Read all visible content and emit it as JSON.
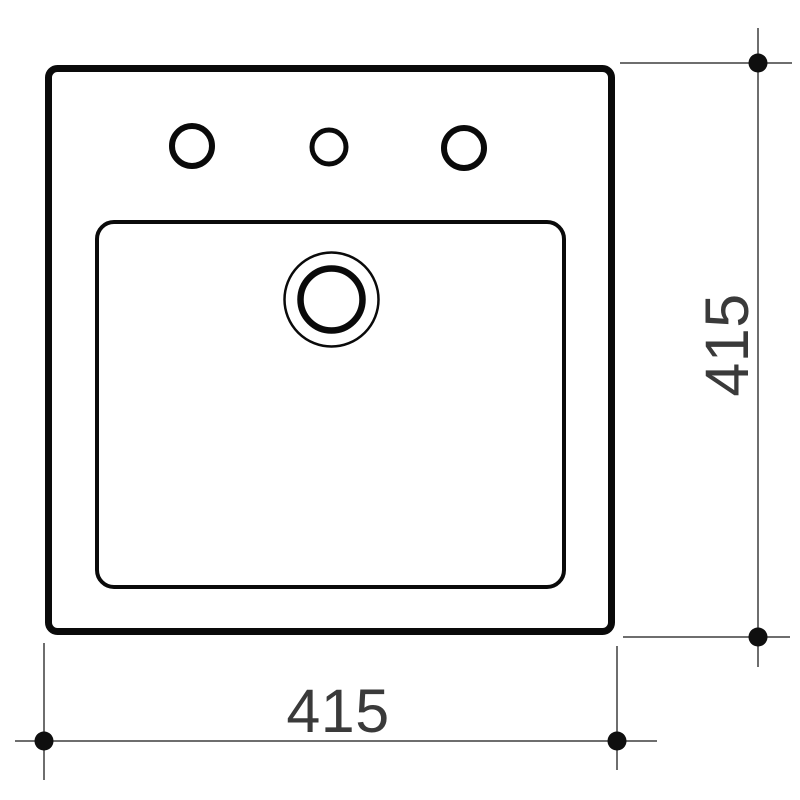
{
  "drawing": {
    "title": "square-basin-top-view-technical-drawing",
    "outline_color": "#0a0a0a",
    "dimension_line_color": "#6e6e6e",
    "dimension_text_color": "#3a3a3a",
    "dot_color": "#0f0f0f",
    "background_color": "#ffffff",
    "tap_hole_count": 3,
    "width_dimension": {
      "value": "415",
      "orientation": "horizontal"
    },
    "height_dimension": {
      "value": "415",
      "orientation": "vertical"
    }
  }
}
